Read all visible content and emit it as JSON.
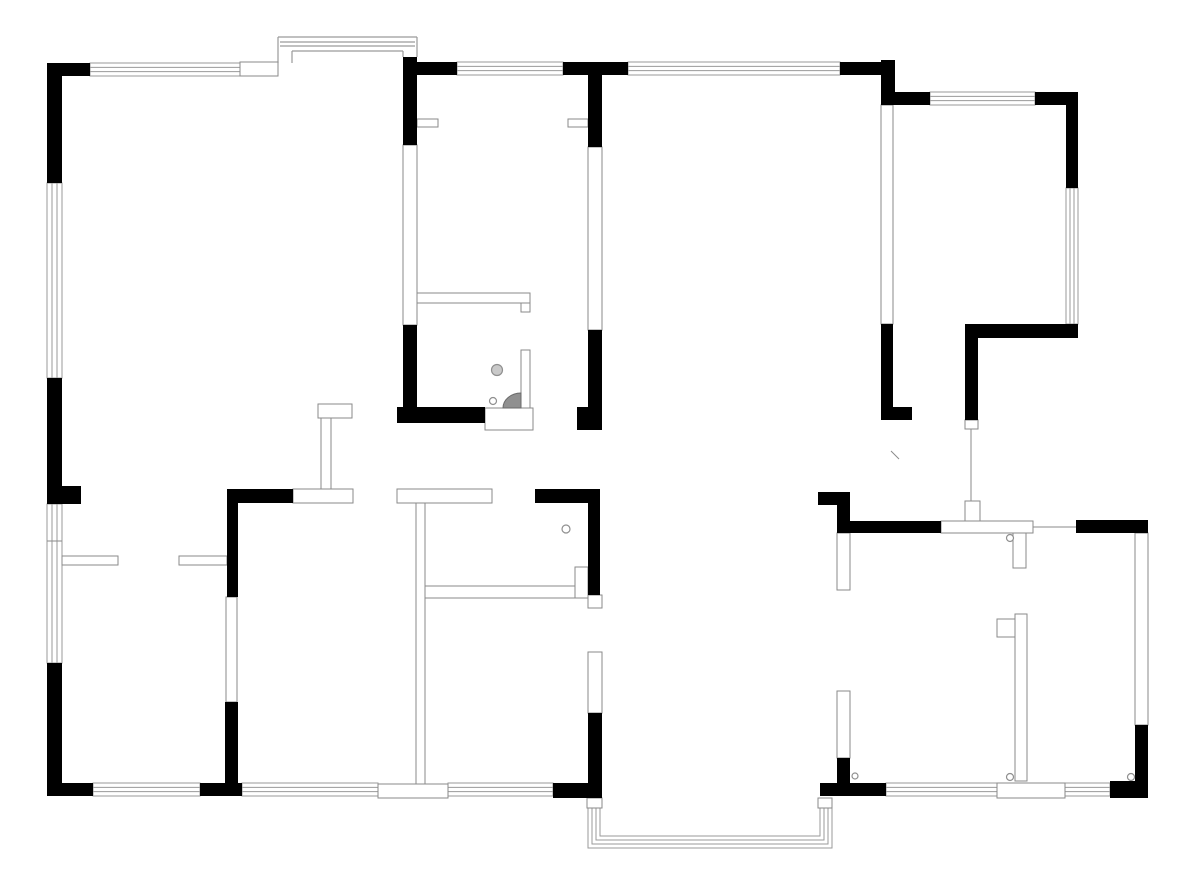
{
  "canvas": {
    "width": 1200,
    "height": 886,
    "background": "#ffffff"
  },
  "colors": {
    "wall_black": "#000000",
    "wall_outline": "#8a8a8a",
    "window_line": "#9a9a9a",
    "thin_fill": "#ffffff",
    "fixture_gray": "#909090",
    "drain_fill": "#c9c9c9"
  },
  "plan": {
    "black_walls": [
      {
        "name": "ext-top-corner-nw",
        "x": 47,
        "y": 63,
        "w": 43,
        "h": 13
      },
      {
        "name": "ext-left-wall-upper",
        "x": 47,
        "y": 63,
        "w": 15,
        "h": 120
      },
      {
        "name": "ext-top-wall-seg-a",
        "x": 417,
        "y": 62,
        "w": 40,
        "h": 13
      },
      {
        "name": "column-bath-left",
        "x": 403,
        "y": 57,
        "w": 14,
        "h": 88
      },
      {
        "name": "ext-top-wall-seg-b",
        "x": 563,
        "y": 62,
        "w": 65,
        "h": 13
      },
      {
        "name": "column-bath-right",
        "x": 588,
        "y": 75,
        "w": 14,
        "h": 72
      },
      {
        "name": "ext-top-wall-seg-c",
        "x": 840,
        "y": 62,
        "w": 42,
        "h": 13
      },
      {
        "name": "column-top-right",
        "x": 881,
        "y": 60,
        "w": 14,
        "h": 45
      },
      {
        "name": "ext-top-wall-seg-d",
        "x": 895,
        "y": 92,
        "w": 35,
        "h": 13
      },
      {
        "name": "ext-top-corner-ne",
        "x": 1035,
        "y": 92,
        "w": 43,
        "h": 13
      },
      {
        "name": "ext-right-wall-upper",
        "x": 1066,
        "y": 105,
        "w": 12,
        "h": 83
      },
      {
        "name": "ne-room-bottom-wall",
        "x": 965,
        "y": 324,
        "w": 113,
        "h": 14
      },
      {
        "name": "ne-room-left-wall-lower",
        "x": 881,
        "y": 324,
        "w": 12,
        "h": 96
      },
      {
        "name": "ne-room-wall-foot",
        "x": 893,
        "y": 407,
        "w": 19,
        "h": 13
      },
      {
        "name": "ne-door-post-wall",
        "x": 965,
        "y": 338,
        "w": 13,
        "h": 82
      },
      {
        "name": "ext-left-wall-mid",
        "x": 47,
        "y": 378,
        "w": 15,
        "h": 126
      },
      {
        "name": "ext-left-wall-nub",
        "x": 62,
        "y": 486,
        "w": 19,
        "h": 18
      },
      {
        "name": "ext-left-wall-lower",
        "x": 47,
        "y": 663,
        "w": 15,
        "h": 132
      },
      {
        "name": "ext-bottom-corner-sw",
        "x": 47,
        "y": 783,
        "w": 46,
        "h": 13
      },
      {
        "name": "ext-bottom-seg-a",
        "x": 200,
        "y": 783,
        "w": 42,
        "h": 13
      },
      {
        "name": "ext-bottom-corner-mid",
        "x": 553,
        "y": 783,
        "w": 49,
        "h": 15
      },
      {
        "name": "ext-bottom-seg-b",
        "x": 820,
        "y": 783,
        "w": 66,
        "h": 13
      },
      {
        "name": "ext-bottom-corner-se",
        "x": 1110,
        "y": 781,
        "w": 38,
        "h": 17
      },
      {
        "name": "ext-right-wall-lower",
        "x": 1135,
        "y": 725,
        "w": 13,
        "h": 60
      },
      {
        "name": "int-wall-corner-h",
        "x": 227,
        "y": 489,
        "w": 66,
        "h": 14
      },
      {
        "name": "int-wall-left-v-upper",
        "x": 227,
        "y": 489,
        "w": 11,
        "h": 108
      },
      {
        "name": "int-wall-left-v-lower",
        "x": 225,
        "y": 702,
        "w": 13,
        "h": 82
      },
      {
        "name": "int-wall-mid-bar",
        "x": 535,
        "y": 489,
        "w": 65,
        "h": 14
      },
      {
        "name": "int-wall-mid-v",
        "x": 588,
        "y": 489,
        "w": 12,
        "h": 106
      },
      {
        "name": "bedroom-wall-v-lower",
        "x": 588,
        "y": 713,
        "w": 14,
        "h": 85
      },
      {
        "name": "bath-left-wall-lower",
        "x": 403,
        "y": 325,
        "w": 14,
        "h": 98
      },
      {
        "name": "bath-bottom-wall",
        "x": 397,
        "y": 407,
        "w": 88,
        "h": 16
      },
      {
        "name": "bath-corner-block",
        "x": 577,
        "y": 407,
        "w": 25,
        "h": 23
      },
      {
        "name": "bath-right-wall-lower",
        "x": 588,
        "y": 330,
        "w": 14,
        "h": 80
      },
      {
        "name": "entry-corner-h",
        "x": 818,
        "y": 492,
        "w": 32,
        "h": 13
      },
      {
        "name": "entry-corner-v",
        "x": 837,
        "y": 505,
        "w": 13,
        "h": 28
      },
      {
        "name": "entry-top-bar",
        "x": 850,
        "y": 521,
        "w": 91,
        "h": 12
      },
      {
        "name": "kitchen-top-bar",
        "x": 1076,
        "y": 520,
        "w": 72,
        "h": 13
      },
      {
        "name": "hall-wall-v-lower",
        "x": 837,
        "y": 758,
        "w": 13,
        "h": 25
      }
    ],
    "thin_walls": [
      {
        "name": "step-wall-top",
        "x": 240,
        "y": 62,
        "w": 38,
        "h": 14
      },
      {
        "name": "opening-stub-left",
        "x": 417,
        "y": 119,
        "w": 21,
        "h": 8
      },
      {
        "name": "opening-stub-right",
        "x": 568,
        "y": 119,
        "w": 20,
        "h": 8
      },
      {
        "name": "bath-partition-h",
        "x": 417,
        "y": 293,
        "w": 113,
        "h": 10
      },
      {
        "name": "bath-partition-hook",
        "x": 521,
        "y": 303,
        "w": 9,
        "h": 9
      },
      {
        "name": "bath-door-leaf",
        "x": 521,
        "y": 350,
        "w": 9,
        "h": 58
      },
      {
        "name": "wall-mid-white-bar",
        "x": 397,
        "y": 489,
        "w": 95,
        "h": 14
      },
      {
        "name": "wall-mid-tcap",
        "x": 293,
        "y": 489,
        "w": 60,
        "h": 14
      },
      {
        "name": "partition-post-hook",
        "x": 318,
        "y": 404,
        "w": 34,
        "h": 14
      },
      {
        "name": "partition-post-v",
        "x": 321,
        "y": 418,
        "w": 10,
        "h": 71
      },
      {
        "name": "wall-left-room-divider",
        "x": 62,
        "y": 556,
        "w": 56,
        "h": 9
      },
      {
        "name": "wall-left-room-stub",
        "x": 179,
        "y": 556,
        "w": 48,
        "h": 9
      },
      {
        "name": "int-wall-left-v-mid",
        "x": 226,
        "y": 597,
        "w": 11,
        "h": 105
      },
      {
        "name": "bedrooms-left-wall",
        "x": 416,
        "y": 503,
        "w": 9,
        "h": 281
      },
      {
        "name": "bottom-wall-tbox",
        "x": 378,
        "y": 784,
        "w": 70,
        "h": 14
      },
      {
        "name": "closet-divider",
        "x": 425,
        "y": 586,
        "w": 152,
        "h": 12
      },
      {
        "name": "closet-divider-notch",
        "x": 575,
        "y": 567,
        "w": 13,
        "h": 31
      },
      {
        "name": "pivot-box-mid",
        "x": 588,
        "y": 595,
        "w": 14,
        "h": 13
      },
      {
        "name": "bedroom-door-panel",
        "x": 588,
        "y": 652,
        "w": 14,
        "h": 61
      },
      {
        "name": "ne-room-left-wall-upper",
        "x": 881,
        "y": 105,
        "w": 12,
        "h": 219
      },
      {
        "name": "bath-left-wall-mid",
        "x": 403,
        "y": 145,
        "w": 14,
        "h": 180
      },
      {
        "name": "bath-right-wall-mid",
        "x": 588,
        "y": 147,
        "w": 14,
        "h": 183
      },
      {
        "name": "pivot-box-ne",
        "x": 965,
        "y": 420,
        "w": 13,
        "h": 9
      },
      {
        "name": "entry-door-band",
        "x": 941,
        "y": 521,
        "w": 92,
        "h": 12
      },
      {
        "name": "entry-door-post",
        "x": 965,
        "y": 501,
        "w": 15,
        "h": 20
      },
      {
        "name": "entry-door-leaf",
        "x": 1013,
        "y": 533,
        "w": 13,
        "h": 35
      },
      {
        "name": "hall-wall-v-upper",
        "x": 837,
        "y": 533,
        "w": 13,
        "h": 57
      },
      {
        "name": "hall-wall-v-mid",
        "x": 837,
        "y": 691,
        "w": 13,
        "h": 67
      },
      {
        "name": "balcony-post-left",
        "x": 587,
        "y": 798,
        "w": 15,
        "h": 10
      },
      {
        "name": "balcony-post-right",
        "x": 818,
        "y": 798,
        "w": 14,
        "h": 10
      },
      {
        "name": "ext-right-window-wall",
        "x": 1135,
        "y": 533,
        "w": 13,
        "h": 192
      },
      {
        "name": "kitchen-wall-v",
        "x": 1015,
        "y": 614,
        "w": 12,
        "h": 167
      },
      {
        "name": "kitchen-wall-hook",
        "x": 997,
        "y": 619,
        "w": 18,
        "h": 18
      },
      {
        "name": "threshold-se",
        "x": 997,
        "y": 783,
        "w": 68,
        "h": 15
      },
      {
        "name": "bath-threshold",
        "x": 485,
        "y": 408,
        "w": 48,
        "h": 22
      }
    ],
    "windows_h": [
      {
        "name": "window-top-a",
        "x": 90,
        "y": 63,
        "w": 150,
        "h": 13
      },
      {
        "name": "window-top-b",
        "x": 457,
        "y": 62,
        "w": 106,
        "h": 13
      },
      {
        "name": "window-top-c",
        "x": 628,
        "y": 62,
        "w": 212,
        "h": 13
      },
      {
        "name": "window-top-d",
        "x": 930,
        "y": 92,
        "w": 105,
        "h": 13
      },
      {
        "name": "window-bottom-a",
        "x": 93,
        "y": 783,
        "w": 107,
        "h": 13
      },
      {
        "name": "window-bottom-b",
        "x": 242,
        "y": 783,
        "w": 136,
        "h": 13
      },
      {
        "name": "window-bottom-c",
        "x": 448,
        "y": 783,
        "w": 105,
        "h": 13
      },
      {
        "name": "window-bottom-d",
        "x": 886,
        "y": 783,
        "w": 111,
        "h": 13
      },
      {
        "name": "window-bottom-e",
        "x": 1065,
        "y": 783,
        "w": 45,
        "h": 13
      }
    ],
    "windows_v": [
      {
        "name": "window-left-a",
        "x": 47,
        "y": 183,
        "w": 15,
        "h": 195
      },
      {
        "name": "window-left-b",
        "x": 47,
        "y": 504,
        "w": 15,
        "h": 159
      },
      {
        "name": "window-right-ne",
        "x": 1066,
        "y": 188,
        "w": 12,
        "h": 136
      }
    ],
    "bay_lines": [
      {
        "name": "bay-outer-top",
        "x1": 278,
        "y1": 37,
        "x2": 417,
        "y2": 37
      },
      {
        "name": "bay-glass-1",
        "x1": 280,
        "y1": 42,
        "x2": 415,
        "y2": 42
      },
      {
        "name": "bay-glass-2",
        "x1": 280,
        "y1": 46,
        "x2": 415,
        "y2": 46
      },
      {
        "name": "bay-inner-top",
        "x1": 292,
        "y1": 51,
        "x2": 403,
        "y2": 51
      },
      {
        "name": "bay-left-outer",
        "x1": 278,
        "y1": 37,
        "x2": 278,
        "y2": 63
      },
      {
        "name": "bay-left-inner",
        "x1": 292,
        "y1": 51,
        "x2": 292,
        "y2": 63
      },
      {
        "name": "bay-right-outer",
        "x1": 417,
        "y1": 37,
        "x2": 417,
        "y2": 57
      },
      {
        "name": "bay-right-inner",
        "x1": 403,
        "y1": 51,
        "x2": 403,
        "y2": 57
      }
    ],
    "balcony_paths": [
      {
        "name": "balcony-line-1",
        "d": "M 588 798 L 588 848 L 832 848 L 832 798"
      },
      {
        "name": "balcony-line-2",
        "d": "M 592 798 L 592 844 L 828 844 L 828 798"
      },
      {
        "name": "balcony-line-3",
        "d": "M 596 798 L 596 840 L 824 840 L 824 798"
      },
      {
        "name": "balcony-line-4",
        "d": "M 600 798 L 600 836 L 820 836 L 820 798"
      }
    ],
    "lines": [
      {
        "name": "door-line-ne",
        "x1": 971,
        "y1": 429,
        "x2": 971,
        "y2": 501
      },
      {
        "name": "opening-line-kitchen",
        "x1": 1033,
        "y1": 527,
        "x2": 1076,
        "y2": 527
      },
      {
        "name": "window-left-divider",
        "x1": 47,
        "y1": 541,
        "x2": 62,
        "y2": 541
      },
      {
        "name": "door-swing-tick",
        "x1": 891,
        "y1": 451,
        "x2": 899,
        "y2": 459
      }
    ],
    "circles": [
      {
        "name": "bath-drain",
        "cx": 497,
        "cy": 370,
        "r": 5.5,
        "filled": true
      },
      {
        "name": "bath-hinge",
        "cx": 493,
        "cy": 401,
        "r": 3.5,
        "filled": false
      },
      {
        "name": "closet-door-hinge",
        "cx": 566,
        "cy": 529,
        "r": 4,
        "filled": false
      },
      {
        "name": "entry-door-hinge",
        "cx": 1010,
        "cy": 538,
        "r": 3.5,
        "filled": false
      },
      {
        "name": "hinge-hall",
        "cx": 855,
        "cy": 776,
        "r": 3,
        "filled": false
      },
      {
        "name": "hinge-kitchen-a",
        "cx": 1010,
        "cy": 777,
        "r": 3.5,
        "filled": false
      },
      {
        "name": "hinge-kitchen-b",
        "cx": 1131,
        "cy": 777,
        "r": 3.5,
        "filled": false
      }
    ],
    "wedge": {
      "name": "shower-wedge",
      "d": "M 521 393 A 18 15 0 0 0 503 408 L 521 408 Z"
    }
  }
}
